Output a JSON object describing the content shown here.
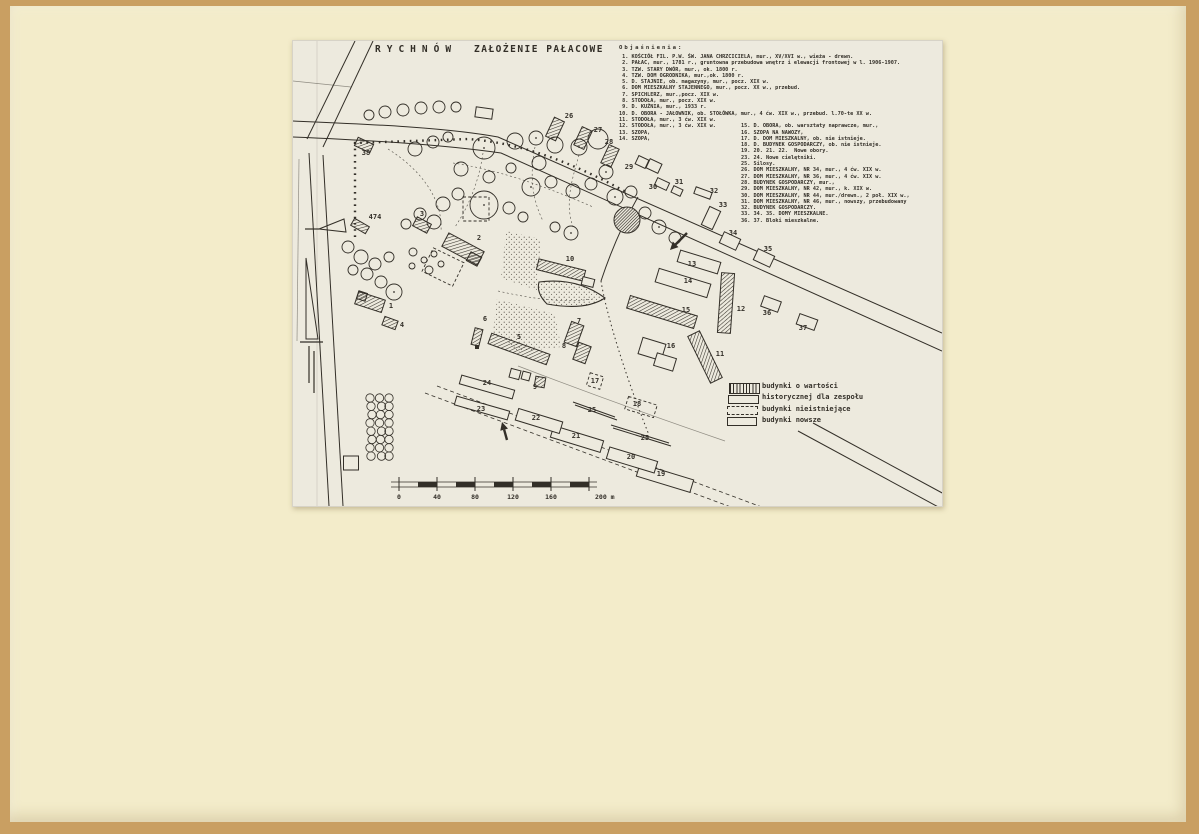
{
  "page": {
    "background": "#c99f62",
    "paper": "#f3ecca",
    "sheet": "#edeade",
    "ink": "#332f28"
  },
  "titles": {
    "main": "RYCHNÓW",
    "sub": "ZAŁOŻENIE PAŁACOWE"
  },
  "legend": {
    "header": "Objaśnienia:",
    "col1": [
      " 1. KOŚCIÓŁ FIL. P.W. ŚW. JANA CHRZCICIELA, mur., XV/XVI w., wieża - drewn.",
      " 2. PAŁAC, mur., 1781 r., gruntowna przebudowa wnętrz i elewacji frontowej w l. 1906-1907.",
      " 3. TZW. STARY DWÓR, mur., ok. 1800 r.",
      " 4. TZW. DOM OGRODNIKA, mur.,ok. 1800 r.",
      " 5. D. STAJNIE, ob. magazyny, mur., pocz. XIX w.",
      " 6. DOM MIESZKALNY STAJENNEGO, mur., pocz. XX w., przebud.",
      " 7. SPICHLERZ, mur.,pocz. XIX w.",
      " 8. STODOŁA, mur., pocz. XIX w.",
      " 9. D. KUŹNIA, mur., 1933 r.",
      "10. D. OBORA - JAŁOWNIK, ob. STOŁÓWKA, mur., 4 ćw. XIX w., przebud. l.70-te XX w.",
      "11. STODOŁA, mur., 3 ćw. XIX w.",
      "12. STODOŁA, mur., 3 ćw. XIX w.",
      "13. SZOPA,",
      "14. SZOPA,"
    ],
    "col2": [
      "15. D. OBORA, ob. warsztaty naprawcze, mur.,",
      "16. SZOPA NA NAWOZY,",
      "17. D. DOM MIESZKALNY, ob. nie istnieje.",
      "18. D. BUDYNEK GOSPODARCZY, ob. nie istnieje.",
      "19. 20. 21. 22.  Nowe obory.",
      "23. 24. Nowe cielętniki.",
      "25. Silosy.",
      "26. DOM MIESZKALNY, NR 34, mur., 4 ćw. XIX w.",
      "27. DOM MIESZKALNY, NR 36, mur., 4 ćw. XIX w.",
      "28. BUDYNEK GOSPODARCZY, mur.,",
      "29. DOM MIESZKALNY, NR 42, mur., k. XIX w.",
      "30. DOM MIESZKALNY, NR 44, mur./drewn., 2 poł. XIX w.,",
      "31. DOM MIESZKALNY, NR 46, mur., nowszy, przebudowany",
      "32. BUDYNEK GOSPODARCZY.",
      "33. 34. 35. DOMY MIESZKALNE.",
      "36. 37. Bloki mieszkalne."
    ]
  },
  "key": {
    "l1": "budynki o wartości",
    "l2": "historycznej dla zespołu",
    "l3": "budynki nieistniejące",
    "l4": "budynki nowsze"
  },
  "map": {
    "roads": [
      [
        "M0,80 C70,83 150,86 205,96 L649,292",
        "s"
      ],
      [
        "M0,96 C70,99 145,103 208,112 L649,310",
        "s"
      ],
      [
        "M62,0 L14,98",
        "s"
      ],
      [
        "M80,0 L30,106",
        "s"
      ],
      [
        "M16,112 C22,200 27,300 36,465",
        "s"
      ],
      [
        "M30,114 C36,200 41,300 50,465",
        "s"
      ],
      [
        "M345,156 C330,182 318,210 308,240",
        "s"
      ],
      [
        "M308,240 C313,272 332,334 356,394",
        "o"
      ],
      [
        "M225,325 C280,346 350,372 432,400",
        "f"
      ],
      [
        "M505,390 L649,468",
        "s"
      ],
      [
        "M520,382 L664,460",
        "s"
      ],
      [
        "M132,352 L470,478",
        "d"
      ],
      [
        "M144,345 L482,471",
        "d"
      ],
      [
        "M62,196 L62,102 L175,98 C230,102 280,122 335,152",
        "q"
      ],
      [
        "M95,108 C130,130 150,160 148,190",
        "p"
      ],
      [
        "M190,112 C186,140 176,165 162,186",
        "p"
      ],
      [
        "M242,106 C236,136 240,160 250,180",
        "p"
      ],
      [
        "M160,122 C200,128 245,142 300,166",
        "p"
      ],
      [
        "M286,114 C278,142 272,162 280,186",
        "p"
      ],
      [
        "M205,250 C240,258 270,262 300,258",
        "p"
      ],
      [
        "M280,361 L322,376",
        "s"
      ],
      [
        "M282,364 L324,379",
        "s"
      ],
      [
        "M318,384 L376,402",
        "s"
      ],
      [
        "M320,387 L378,405",
        "s"
      ],
      [
        "M24,0 L24,465",
        "f2"
      ],
      [
        "M0,40 L58,46",
        "f"
      ],
      [
        "M6,118 L4,300",
        "f"
      ]
    ],
    "ponds": [
      [
        "M213,190 L248,198 L244,249 L208,237 Z",
        0
      ],
      [
        "M204,258 L262,273 L268,306 L226,311 L200,291 Z",
        0
      ],
      [
        "M246,241 Q284,236 312,257 Q292,270 254,263 Q243,252 246,241 Z",
        1
      ]
    ],
    "dark_pond": [
      334,
      179,
      13
    ],
    "trees": [
      [
        76,
        74,
        5,
        0
      ],
      [
        92,
        71,
        6,
        0
      ],
      [
        110,
        69,
        6,
        0
      ],
      [
        128,
        67,
        6,
        0
      ],
      [
        146,
        66,
        6,
        0
      ],
      [
        163,
        66,
        5,
        0
      ],
      [
        122,
        108,
        7,
        0
      ],
      [
        140,
        101,
        6,
        0
      ],
      [
        155,
        96,
        5,
        0
      ],
      [
        191,
        107,
        11,
        1
      ],
      [
        222,
        100,
        8,
        0
      ],
      [
        243,
        97,
        7,
        1
      ],
      [
        262,
        104,
        8,
        0
      ],
      [
        286,
        106,
        8,
        1
      ],
      [
        305,
        98,
        10,
        0
      ],
      [
        168,
        128,
        7,
        0
      ],
      [
        196,
        136,
        6,
        0
      ],
      [
        218,
        127,
        5,
        0
      ],
      [
        238,
        146,
        9,
        1
      ],
      [
        258,
        141,
        6,
        0
      ],
      [
        246,
        122,
        7,
        0
      ],
      [
        280,
        150,
        7,
        0
      ],
      [
        298,
        143,
        6,
        0
      ],
      [
        313,
        131,
        7,
        1
      ],
      [
        322,
        156,
        8,
        1
      ],
      [
        338,
        151,
        6,
        0
      ],
      [
        191,
        164,
        14,
        1
      ],
      [
        165,
        153,
        6,
        0
      ],
      [
        150,
        163,
        7,
        0
      ],
      [
        216,
        167,
        6,
        0
      ],
      [
        230,
        176,
        5,
        0
      ],
      [
        278,
        192,
        7,
        1
      ],
      [
        262,
        186,
        5,
        0
      ],
      [
        352,
        172,
        6,
        0
      ],
      [
        366,
        186,
        7,
        1
      ],
      [
        382,
        197,
        6,
        0
      ],
      [
        141,
        181,
        7,
        0
      ],
      [
        127,
        173,
        6,
        0
      ],
      [
        113,
        183,
        5,
        0
      ],
      [
        101,
        251,
        8,
        1
      ],
      [
        88,
        241,
        6,
        0
      ],
      [
        55,
        206,
        6,
        0
      ],
      [
        68,
        216,
        7,
        0
      ],
      [
        82,
        223,
        6,
        0
      ],
      [
        96,
        216,
        5,
        0
      ],
      [
        60,
        229,
        5,
        0
      ],
      [
        74,
        233,
        6,
        0
      ],
      [
        120,
        211,
        4,
        0
      ],
      [
        131,
        219,
        3,
        0
      ],
      [
        141,
        213,
        3,
        0
      ],
      [
        119,
        225,
        3,
        0
      ],
      [
        136,
        229,
        4,
        0
      ],
      [
        148,
        223,
        3,
        0
      ]
    ],
    "orchard": {
      "cols": 3,
      "rows": 8,
      "x": 78,
      "y": 357,
      "dx": 9.5,
      "dy": 8.3,
      "r": 4.2
    },
    "buildings": [
      [
        "38",
        "h",
        71,
        104,
        17,
        9,
        25
      ],
      [
        "474",
        "h",
        67,
        185,
        17,
        8,
        30
      ],
      [
        "3",
        "h",
        129,
        184,
        16,
        10,
        28
      ],
      [
        "2",
        "h",
        170,
        208,
        40,
        15,
        28
      ],
      [
        "2w",
        "h",
        181,
        218,
        12,
        10,
        28
      ],
      [
        "1",
        "h",
        77,
        261,
        28,
        13,
        18
      ],
      [
        "1t",
        "h",
        69,
        255,
        9,
        8,
        18
      ],
      [
        "4",
        "h",
        97,
        282,
        14,
        9,
        20
      ],
      [
        "10",
        "h",
        268,
        229,
        48,
        11,
        14
      ],
      [
        "10b",
        "n",
        295,
        241,
        12,
        8,
        14
      ],
      [
        "5",
        "h",
        226,
        308,
        62,
        11,
        20
      ],
      [
        "6",
        "h",
        184,
        296,
        8,
        17,
        14
      ],
      [
        "7",
        "h",
        281,
        293,
        13,
        22,
        20
      ],
      [
        "8",
        "h",
        289,
        312,
        13,
        18,
        20
      ],
      [
        "9",
        "h",
        247,
        341,
        10,
        10,
        10
      ],
      [
        "11",
        "h",
        412,
        316,
        13,
        52,
        -26
      ],
      [
        "12",
        "h",
        433,
        262,
        13,
        60,
        4
      ],
      [
        "15",
        "h",
        369,
        271,
        70,
        13,
        17
      ],
      [
        "26",
        "h",
        262,
        88,
        11,
        21,
        25
      ],
      [
        "27",
        "h",
        290,
        97,
        11,
        20,
        25
      ],
      [
        "28",
        "h",
        317,
        115,
        11,
        20,
        25
      ],
      [
        "13",
        "n",
        406,
        221,
        42,
        12,
        17
      ],
      [
        "14",
        "n",
        390,
        242,
        54,
        14,
        17
      ],
      [
        "16a",
        "n",
        359,
        308,
        24,
        17,
        17
      ],
      [
        "16b",
        "n",
        372,
        321,
        20,
        13,
        17
      ],
      [
        "19",
        "n",
        372,
        437,
        56,
        13,
        17
      ],
      [
        "20",
        "n",
        339,
        419,
        50,
        12,
        17
      ],
      [
        "21",
        "n",
        284,
        398,
        52,
        12,
        17
      ],
      [
        "22",
        "n",
        246,
        380,
        46,
        12,
        17
      ],
      [
        "23",
        "n",
        189,
        367,
        55,
        9,
        16
      ],
      [
        "24",
        "n",
        194,
        346,
        55,
        9,
        16
      ],
      [
        "29a",
        "n",
        349,
        121,
        11,
        9,
        25
      ],
      [
        "29b",
        "n",
        361,
        125,
        13,
        10,
        25
      ],
      [
        "30",
        "n",
        369,
        143,
        13,
        8,
        25
      ],
      [
        "31",
        "n",
        384,
        150,
        10,
        7,
        25
      ],
      [
        "32",
        "n",
        410,
        152,
        17,
        7,
        20
      ],
      [
        "33",
        "n",
        418,
        177,
        12,
        20,
        25
      ],
      [
        "34",
        "n",
        437,
        200,
        18,
        12,
        25
      ],
      [
        "35",
        "n",
        471,
        217,
        18,
        12,
        25
      ],
      [
        "36",
        "n",
        478,
        263,
        18,
        11,
        20
      ],
      [
        "37",
        "n",
        514,
        281,
        19,
        11,
        20
      ],
      [
        "x1",
        "n",
        191,
        72,
        17,
        10,
        8
      ],
      [
        "x2",
        "n",
        58,
        422,
        15,
        14,
        0
      ],
      [
        "x3",
        "n",
        222,
        333,
        10,
        9,
        15
      ],
      [
        "x4",
        "n",
        233,
        335,
        8,
        8,
        15
      ],
      [
        "17",
        "g",
        302,
        340,
        14,
        13,
        17
      ],
      [
        "18",
        "g",
        348,
        366,
        30,
        13,
        17
      ],
      [
        "g1",
        "g",
        150,
        226,
        34,
        26,
        26
      ],
      [
        "g2",
        "g",
        183,
        168,
        26,
        24,
        0
      ]
    ],
    "labels": [
      [
        "38",
        73,
        114
      ],
      [
        "474",
        82,
        178
      ],
      [
        "3",
        129,
        175
      ],
      [
        "2",
        186,
        199
      ],
      [
        "1",
        98,
        267
      ],
      [
        "4",
        109,
        286
      ],
      [
        "10",
        277,
        220
      ],
      [
        "5",
        226,
        298
      ],
      [
        "6",
        192,
        280
      ],
      [
        "7",
        286,
        282
      ],
      [
        "8",
        271,
        307
      ],
      [
        "9",
        242,
        348
      ],
      [
        "24",
        194,
        344
      ],
      [
        "23",
        188,
        370
      ],
      [
        "22",
        243,
        379
      ],
      [
        "21",
        283,
        397
      ],
      [
        "20",
        338,
        418
      ],
      [
        "19",
        368,
        435
      ],
      [
        "25",
        299,
        371
      ],
      [
        "25",
        352,
        399
      ],
      [
        "17",
        302,
        342
      ],
      [
        "18",
        344,
        365
      ],
      [
        "16",
        378,
        307
      ],
      [
        "15",
        393,
        271
      ],
      [
        "14",
        395,
        242
      ],
      [
        "13",
        399,
        225
      ],
      [
        "12",
        448,
        270
      ],
      [
        "11",
        427,
        315
      ],
      [
        "26",
        276,
        77
      ],
      [
        "27",
        305,
        91
      ],
      [
        "28",
        316,
        103
      ],
      [
        "29",
        336,
        128
      ],
      [
        "30",
        360,
        148
      ],
      [
        "31",
        386,
        143
      ],
      [
        "32",
        421,
        152
      ],
      [
        "33",
        430,
        166
      ],
      [
        "34",
        440,
        194
      ],
      [
        "35",
        475,
        210
      ],
      [
        "36",
        474,
        274
      ],
      [
        "37",
        510,
        289
      ]
    ],
    "symbols": [
      [
        "path",
        "M13,217 L13,298 L25,298 Z"
      ],
      [
        "line",
        16,
        305,
        16,
        342
      ],
      [
        "line",
        21,
        310,
        21,
        352
      ],
      [
        "line",
        7,
        301,
        30,
        301
      ],
      [
        "line",
        12,
        188,
        26,
        188
      ],
      [
        "path",
        "M26,188 L51,178 L53,191 Z"
      ],
      [
        "sq",
        182,
        304,
        4
      ]
    ],
    "arrows": [
      [
        394,
        192,
        377,
        209
      ],
      [
        214,
        399,
        209,
        381
      ]
    ],
    "scale": {
      "x": 106,
      "y": 441,
      "seg": 19,
      "segs": 10,
      "tick_every": 2,
      "labels": [
        "0",
        "40",
        "80",
        "120",
        "160"
      ],
      "end": "200 m"
    }
  }
}
